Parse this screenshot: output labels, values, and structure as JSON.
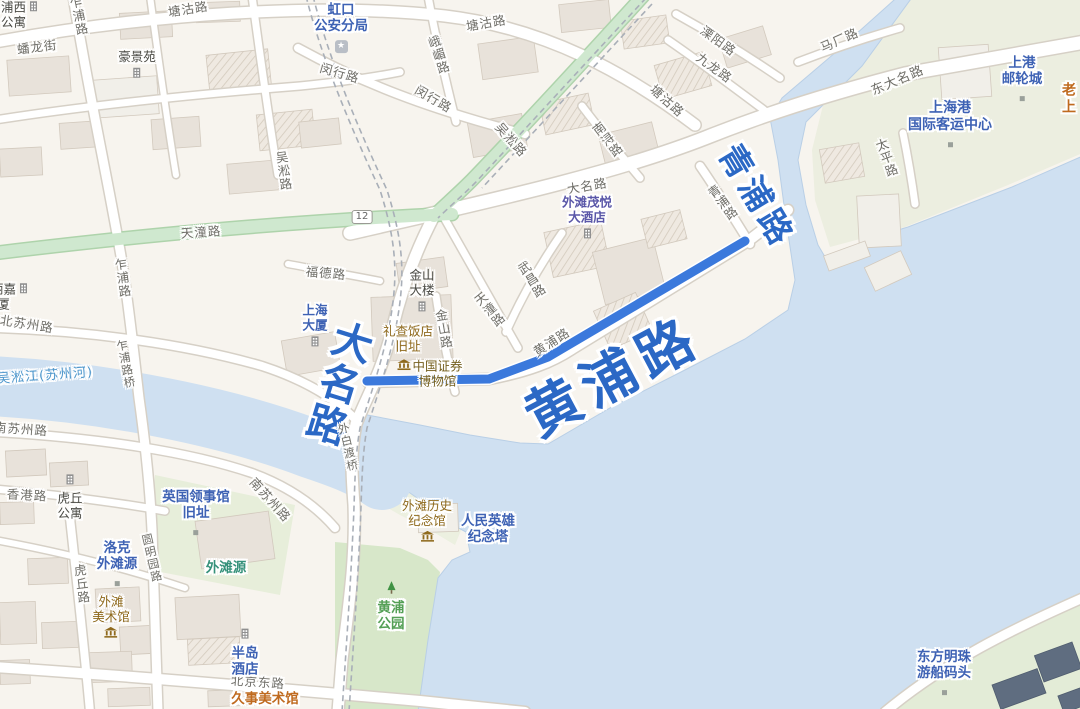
{
  "map": {
    "colors": {
      "water": "#cfe0f1",
      "land": "#f7f4ee",
      "route": "#3b79dc",
      "highlight_text": "#2b68c5",
      "green_road": "#cfe8cf",
      "park": "#d7e7c9"
    },
    "route": {
      "name": "黄浦路",
      "color": "#3b79dc",
      "points": [
        [
          367,
          381
        ],
        [
          489,
          379
        ],
        [
          548,
          357
        ],
        [
          745,
          241
        ]
      ]
    },
    "route_badge": {
      "text": "12"
    },
    "water_label": {
      "text": "吴淞江(苏州河)"
    },
    "highlight_labels": [
      {
        "text": "大名路"
      },
      {
        "text": "黄浦路"
      },
      {
        "text": "青浦路"
      }
    ],
    "road_labels": [
      {
        "t": "塘沽路",
        "x": 188,
        "y": 8,
        "r": -9
      },
      {
        "t": "乍浦路",
        "x": 78,
        "y": 16,
        "r": -12,
        "v": 1
      },
      {
        "t": "蟠龙街",
        "x": 37,
        "y": 46,
        "r": -7
      },
      {
        "t": "闵行路",
        "x": 340,
        "y": 72,
        "r": 16
      },
      {
        "t": "闵行路",
        "x": 434,
        "y": 98,
        "r": 30
      },
      {
        "t": "峨嵋路",
        "x": 438,
        "y": 55,
        "r": -18,
        "v": 1
      },
      {
        "t": "塘沽路",
        "x": 486,
        "y": 22,
        "r": -10
      },
      {
        "t": "吴淞路",
        "x": 512,
        "y": 139,
        "r": 48
      },
      {
        "t": "塘沽路",
        "x": 668,
        "y": 100,
        "r": 42
      },
      {
        "t": "溧阳路",
        "x": 719,
        "y": 40,
        "r": 36
      },
      {
        "t": "九龙路",
        "x": 715,
        "y": 67,
        "r": 36
      },
      {
        "t": "马厂路",
        "x": 839,
        "y": 39,
        "r": -24
      },
      {
        "t": "东大名路",
        "x": 897,
        "y": 79,
        "r": -23,
        "s": 13
      },
      {
        "t": "太平路",
        "x": 886,
        "y": 158,
        "r": -20,
        "v": 1
      },
      {
        "t": "大名路",
        "x": 587,
        "y": 185,
        "r": -10
      },
      {
        "t": "南浔路",
        "x": 607,
        "y": 140,
        "r": -38,
        "v": 1
      },
      {
        "t": "青浦路",
        "x": 722,
        "y": 203,
        "r": -37,
        "v": 1
      },
      {
        "t": "吴淞路",
        "x": 283,
        "y": 171,
        "r": -8,
        "v": 1
      },
      {
        "t": "天潼路",
        "x": 201,
        "y": 231,
        "r": -4
      },
      {
        "t": "福德路",
        "x": 326,
        "y": 272,
        "r": 5
      },
      {
        "t": "天潼路",
        "x": 489,
        "y": 310,
        "r": -39,
        "v": 1
      },
      {
        "t": "武昌路",
        "x": 531,
        "y": 280,
        "r": -32,
        "v": 1
      },
      {
        "t": "金山路",
        "x": 443,
        "y": 329,
        "r": -10,
        "v": 1
      },
      {
        "t": "黄浦路",
        "x": 551,
        "y": 341,
        "r": -33
      },
      {
        "t": "北苏州路",
        "x": 27,
        "y": 323,
        "r": 9
      },
      {
        "t": "乍浦路",
        "x": 122,
        "y": 278,
        "r": -8,
        "v": 1
      },
      {
        "t": "乍浦路桥",
        "x": 126,
        "y": 364,
        "r": -11,
        "v": 1,
        "s": 11.5
      },
      {
        "t": "外白渡桥",
        "x": 348,
        "y": 447,
        "r": -13,
        "v": 1,
        "s": 11.5
      },
      {
        "t": "南苏州路",
        "x": 21,
        "y": 428,
        "r": 4
      },
      {
        "t": "香港路",
        "x": 27,
        "y": 494,
        "r": 3
      },
      {
        "t": "南苏州路",
        "x": 271,
        "y": 499,
        "r": 48
      },
      {
        "t": "北京东路",
        "x": 258,
        "y": 681,
        "r": 4
      },
      {
        "t": "圆明园路",
        "x": 152,
        "y": 558,
        "r": -13,
        "v": 1,
        "s": 11.5
      },
      {
        "t": "虎丘路",
        "x": 81,
        "y": 584,
        "r": -7,
        "v": 1
      }
    ],
    "poi_labels": [
      {
        "lines": [
          "浦西",
          "公寓"
        ],
        "x": 20,
        "y": 15,
        "cls": "p-dark",
        "icon": "building",
        "ipos": "right"
      },
      {
        "lines": [
          "豪景苑"
        ],
        "x": 137,
        "y": 66,
        "cls": "p-dark",
        "icon": "building",
        "ipos": "below"
      },
      {
        "lines": [
          "虹口",
          "公安分局"
        ],
        "x": 341,
        "y": 28,
        "cls": "p-blue",
        "s": 13.5,
        "icon": "police-badge",
        "ipos": "below"
      },
      {
        "lines": [
          "上港",
          "邮轮城"
        ],
        "x": 1022,
        "y": 81,
        "cls": "p-blue",
        "s": 13.5,
        "icon": "dot",
        "ipos": "below"
      },
      {
        "lines": [
          "老上"
        ],
        "x": 1069,
        "y": 99,
        "cls": "p-orange",
        "s": 14
      },
      {
        "lines": [
          "上海港",
          "国际客运中心"
        ],
        "x": 950,
        "y": 126,
        "cls": "p-blue",
        "s": 14,
        "icon": "dot",
        "ipos": "below"
      },
      {
        "lines": [
          "外滩茂悦",
          "大酒店"
        ],
        "x": 587,
        "y": 219,
        "cls": "p-indigo",
        "icon": "building",
        "ipos": "below"
      },
      {
        "lines": [
          "金山",
          "大楼"
        ],
        "x": 422,
        "y": 292,
        "cls": "p-dark",
        "icon": "building",
        "ipos": "below"
      },
      {
        "lines": [
          "礼查饭店",
          "旧址"
        ],
        "x": 408,
        "y": 339,
        "cls": "p-brown"
      },
      {
        "lines": [
          "中国证券",
          "博物馆"
        ],
        "x": 430,
        "y": 374,
        "cls": "p-brown2",
        "icon": "museum",
        "ipos": "left"
      },
      {
        "lines": [
          "上海",
          "大厦"
        ],
        "x": 315,
        "y": 327,
        "cls": "p-blue",
        "icon": "building",
        "ipos": "below"
      },
      {
        "lines": [
          "丽嘉",
          "厦"
        ],
        "x": 10,
        "y": 297,
        "cls": "p-dark",
        "icon": "building",
        "ipos": "right"
      },
      {
        "lines": [
          "虎丘",
          "公寓"
        ],
        "x": 70,
        "y": 497,
        "cls": "p-dark",
        "icon": "building",
        "ipos": "above"
      },
      {
        "lines": [
          "英国领事馆",
          "旧址"
        ],
        "x": 196,
        "y": 515,
        "cls": "p-blue",
        "s": 13.5,
        "icon": "dot",
        "ipos": "below"
      },
      {
        "lines": [
          "洛克",
          "外滩源"
        ],
        "x": 117,
        "y": 566,
        "cls": "p-blue",
        "s": 13.5,
        "icon": "dot",
        "ipos": "below"
      },
      {
        "lines": [
          "外滩源"
        ],
        "x": 226,
        "y": 569,
        "cls": "p-teal",
        "s": 13.5
      },
      {
        "lines": [
          "外滩",
          "美术馆"
        ],
        "x": 111,
        "y": 618,
        "cls": "p-brown",
        "icon": "museum",
        "ipos": "below"
      },
      {
        "lines": [
          "半岛",
          "酒店"
        ],
        "x": 245,
        "y": 653,
        "cls": "p-blue",
        "s": 13.5,
        "icon": "building",
        "ipos": "above"
      },
      {
        "lines": [
          "久事美术馆"
        ],
        "x": 265,
        "y": 700,
        "cls": "p-orange",
        "s": 13.5
      },
      {
        "lines": [
          "外滩历史",
          "纪念馆"
        ],
        "x": 427,
        "y": 522,
        "cls": "p-brown",
        "icon": "museum",
        "ipos": "below"
      },
      {
        "lines": [
          "人民英雄",
          "纪念塔"
        ],
        "x": 488,
        "y": 530,
        "cls": "p-blue",
        "s": 13.5
      },
      {
        "lines": [
          "黄浦",
          "公园"
        ],
        "x": 391,
        "y": 607,
        "cls": "p-green",
        "s": 13.5,
        "icon": "tree",
        "ipos": "above"
      },
      {
        "lines": [
          "东方明珠",
          "游船码头"
        ],
        "x": 944,
        "y": 675,
        "cls": "p-blue",
        "s": 13.5,
        "icon": "dot",
        "ipos": "below"
      }
    ]
  }
}
